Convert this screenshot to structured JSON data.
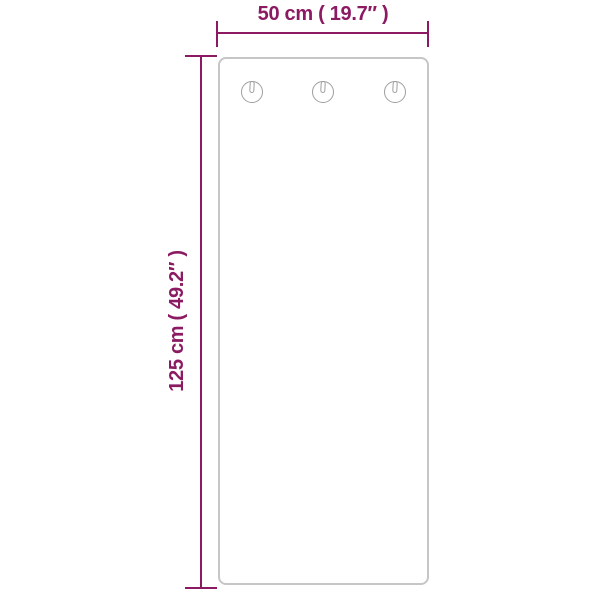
{
  "colors": {
    "accent": "#8B1A62",
    "panel_border": "#c6c6c6",
    "keyhole_stroke": "#9e9e9e",
    "background": "#ffffff"
  },
  "dimensions": {
    "width_label": "50 cm ( 19.7″ )",
    "height_label": "125 cm ( 49.2″ )"
  },
  "panel": {
    "keyhole_count": 3,
    "keyhole_icon": "keyhole-icon"
  }
}
